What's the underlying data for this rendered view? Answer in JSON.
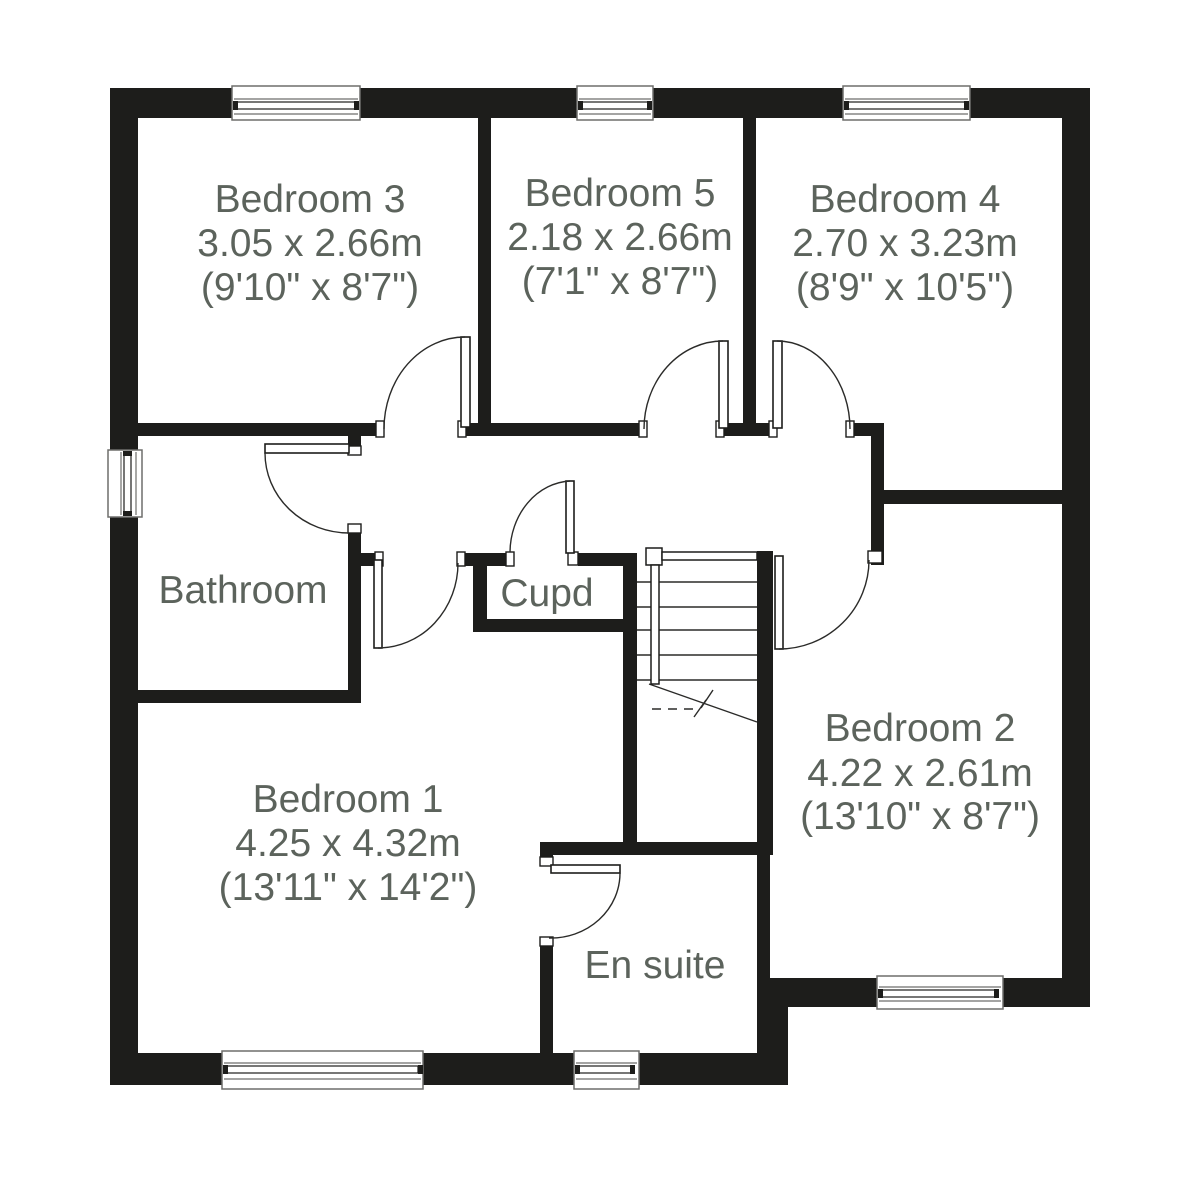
{
  "rooms": {
    "bedroom3": {
      "name": "Bedroom 3",
      "metric": "3.05 x 2.66m",
      "imperial": "(9'10\" x 8'7\")"
    },
    "bedroom5": {
      "name": "Bedroom 5",
      "metric": "2.18 x 2.66m",
      "imperial": "(7'1\" x 8'7\")"
    },
    "bedroom4": {
      "name": "Bedroom 4",
      "metric": "2.70 x 3.23m",
      "imperial": "(8'9\" x 10'5\")"
    },
    "bathroom": {
      "name": "Bathroom"
    },
    "cupboard": {
      "name": "Cupd"
    },
    "bedroom1": {
      "name": "Bedroom 1",
      "metric": "4.25 x 4.32m",
      "imperial": "(13'11\" x 14'2\")"
    },
    "ensuite": {
      "name": "En suite"
    },
    "bedroom2": {
      "name": "Bedroom 2",
      "metric": "4.22 x 2.61m",
      "imperial": "(13'10\" x 8'7\")"
    }
  },
  "colors": {
    "wall": "#1d1d1b",
    "text": "#5c635c",
    "background": "#ffffff"
  }
}
